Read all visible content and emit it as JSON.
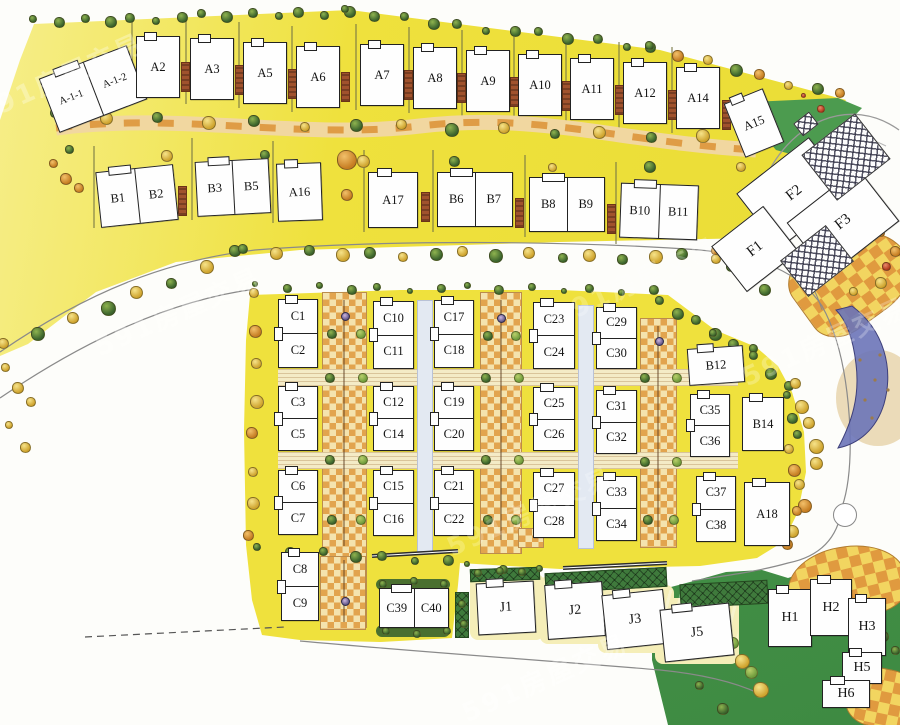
{
  "watermark": {
    "text": "591房屋交易"
  },
  "palette": {
    "lawn_yellow": "#efe13d",
    "lawn_yellow_light": "#f6ee8a",
    "lawn_green": "#4c9b4f",
    "lawn_green_dark": "#3e8a42",
    "hedge_green": "#4a7030",
    "path_tan": "#f1d7a0",
    "path_orange": "#df9c45",
    "paving_orange": "#e2a44e",
    "paving_cream": "#f4e3ae",
    "road_line": "#8a8a8a",
    "building_fill": "#fefefe",
    "building_stroke": "#222222",
    "water_blue": "#6b74b8",
    "brick_brown": "#a0522d",
    "accent_red": "#b23a1d"
  },
  "buildings": [
    {
      "labels": [
        "A-1-1",
        "A-1-2"
      ],
      "x": 46,
      "y": 60,
      "w": 94,
      "h": 58,
      "rot": -21,
      "split": "h",
      "fs": 10.5
    },
    {
      "labels": [
        "A2"
      ],
      "x": 136,
      "y": 36,
      "w": 44,
      "h": 62
    },
    {
      "labels": [
        "A3"
      ],
      "x": 190,
      "y": 38,
      "w": 44,
      "h": 62
    },
    {
      "labels": [
        "A5"
      ],
      "x": 243,
      "y": 42,
      "w": 44,
      "h": 62
    },
    {
      "labels": [
        "A6"
      ],
      "x": 296,
      "y": 46,
      "w": 44,
      "h": 62
    },
    {
      "labels": [
        "A7"
      ],
      "x": 360,
      "y": 44,
      "w": 44,
      "h": 62
    },
    {
      "labels": [
        "A8"
      ],
      "x": 413,
      "y": 47,
      "w": 44,
      "h": 62
    },
    {
      "labels": [
        "A9"
      ],
      "x": 466,
      "y": 50,
      "w": 44,
      "h": 62
    },
    {
      "labels": [
        "A10"
      ],
      "x": 518,
      "y": 54,
      "w": 44,
      "h": 62
    },
    {
      "labels": [
        "A11"
      ],
      "x": 570,
      "y": 58,
      "w": 44,
      "h": 62
    },
    {
      "labels": [
        "A12"
      ],
      "x": 623,
      "y": 62,
      "w": 44,
      "h": 62
    },
    {
      "labels": [
        "A14"
      ],
      "x": 676,
      "y": 67,
      "w": 44,
      "h": 62
    },
    {
      "labels": [
        "A15"
      ],
      "x": 733,
      "y": 94,
      "w": 42,
      "h": 58,
      "rot": -22
    },
    {
      "labels": [
        "B1",
        "B2"
      ],
      "x": 98,
      "y": 168,
      "w": 78,
      "h": 56,
      "rot": -6,
      "split": "h"
    },
    {
      "labels": [
        "B3",
        "B5"
      ],
      "x": 196,
      "y": 160,
      "w": 74,
      "h": 55,
      "rot": -3,
      "split": "h"
    },
    {
      "labels": [
        "A16"
      ],
      "x": 277,
      "y": 163,
      "w": 45,
      "h": 58,
      "rot": -2
    },
    {
      "labels": [
        "A17"
      ],
      "x": 368,
      "y": 172,
      "w": 50,
      "h": 56
    },
    {
      "labels": [
        "B6",
        "B7"
      ],
      "x": 437,
      "y": 172,
      "w": 76,
      "h": 55,
      "split": "h"
    },
    {
      "labels": [
        "B8",
        "B9"
      ],
      "x": 529,
      "y": 177,
      "w": 76,
      "h": 55,
      "split": "h"
    },
    {
      "labels": [
        "B10",
        "B11"
      ],
      "x": 620,
      "y": 184,
      "w": 78,
      "h": 55,
      "rot": 2,
      "split": "h"
    },
    {
      "labels": [
        "F2"
      ],
      "x": 748,
      "y": 158,
      "w": 92,
      "h": 70,
      "rot": -38,
      "plain": true,
      "fs": 15
    },
    {
      "labels": [
        "F3"
      ],
      "x": 798,
      "y": 188,
      "w": 90,
      "h": 68,
      "rot": -38,
      "plain": true,
      "fs": 15
    },
    {
      "labels": [
        "F1"
      ],
      "x": 722,
      "y": 220,
      "w": 66,
      "h": 58,
      "rot": -38,
      "plain": true,
      "fs": 15
    },
    {
      "labels": [
        "C1",
        "C2"
      ],
      "x": 278,
      "y": 299,
      "w": 40,
      "h": 69,
      "split": "v"
    },
    {
      "labels": [
        "C3",
        "C5"
      ],
      "x": 278,
      "y": 386,
      "w": 40,
      "h": 65,
      "split": "v"
    },
    {
      "labels": [
        "C6",
        "C7"
      ],
      "x": 278,
      "y": 470,
      "w": 40,
      "h": 65,
      "split": "v"
    },
    {
      "labels": [
        "C10",
        "C11"
      ],
      "x": 373,
      "y": 301,
      "w": 41,
      "h": 68,
      "split": "v"
    },
    {
      "labels": [
        "C12",
        "C14"
      ],
      "x": 373,
      "y": 386,
      "w": 41,
      "h": 65,
      "split": "v"
    },
    {
      "labels": [
        "C15",
        "C16"
      ],
      "x": 373,
      "y": 470,
      "w": 41,
      "h": 66,
      "split": "v"
    },
    {
      "labels": [
        "C17",
        "C18"
      ],
      "x": 434,
      "y": 300,
      "w": 40,
      "h": 68,
      "split": "v"
    },
    {
      "labels": [
        "C19",
        "C20"
      ],
      "x": 434,
      "y": 386,
      "w": 40,
      "h": 65,
      "split": "v"
    },
    {
      "labels": [
        "C21",
        "C22"
      ],
      "x": 434,
      "y": 470,
      "w": 40,
      "h": 66,
      "split": "v"
    },
    {
      "labels": [
        "C23",
        "C24"
      ],
      "x": 533,
      "y": 302,
      "w": 42,
      "h": 67,
      "split": "v"
    },
    {
      "labels": [
        "C25",
        "C26"
      ],
      "x": 533,
      "y": 387,
      "w": 42,
      "h": 64,
      "split": "v"
    },
    {
      "labels": [
        "C27",
        "C28"
      ],
      "x": 533,
      "y": 472,
      "w": 42,
      "h": 66,
      "split": "v"
    },
    {
      "labels": [
        "C29",
        "C30"
      ],
      "x": 596,
      "y": 307,
      "w": 41,
      "h": 62,
      "split": "v"
    },
    {
      "labels": [
        "C31",
        "C32"
      ],
      "x": 596,
      "y": 390,
      "w": 41,
      "h": 64,
      "split": "v"
    },
    {
      "labels": [
        "C33",
        "C34"
      ],
      "x": 596,
      "y": 476,
      "w": 41,
      "h": 65,
      "split": "v"
    },
    {
      "labels": [
        "B12"
      ],
      "x": 688,
      "y": 347,
      "w": 56,
      "h": 37,
      "rot": -4
    },
    {
      "labels": [
        "C35",
        "C36"
      ],
      "x": 690,
      "y": 394,
      "w": 40,
      "h": 63,
      "split": "v"
    },
    {
      "labels": [
        "B14"
      ],
      "x": 742,
      "y": 397,
      "w": 42,
      "h": 54
    },
    {
      "labels": [
        "C37",
        "C38"
      ],
      "x": 696,
      "y": 476,
      "w": 40,
      "h": 66,
      "split": "v"
    },
    {
      "labels": [
        "A18"
      ],
      "x": 744,
      "y": 482,
      "w": 46,
      "h": 64
    },
    {
      "labels": [
        "C8",
        "C9"
      ],
      "x": 281,
      "y": 552,
      "w": 38,
      "h": 69,
      "split": "v"
    },
    {
      "labels": [
        "C39",
        "C40"
      ],
      "x": 379,
      "y": 588,
      "w": 70,
      "h": 40,
      "split": "h"
    },
    {
      "labels": [
        "J1"
      ],
      "x": 477,
      "y": 582,
      "w": 58,
      "h": 52,
      "rot": -3,
      "fs": 14
    },
    {
      "labels": [
        "J2"
      ],
      "x": 546,
      "y": 583,
      "w": 58,
      "h": 55,
      "rot": -4,
      "fs": 14
    },
    {
      "labels": [
        "J3"
      ],
      "x": 604,
      "y": 592,
      "w": 62,
      "h": 55,
      "rot": -6,
      "fs": 14
    },
    {
      "labels": [
        "J5"
      ],
      "x": 662,
      "y": 606,
      "w": 70,
      "h": 53,
      "rot": -6,
      "fs": 14
    },
    {
      "labels": [
        "H1"
      ],
      "x": 768,
      "y": 589,
      "w": 44,
      "h": 58,
      "fs": 14
    },
    {
      "labels": [
        "H2"
      ],
      "x": 810,
      "y": 579,
      "w": 42,
      "h": 57,
      "fs": 14
    },
    {
      "labels": [
        "H3"
      ],
      "x": 848,
      "y": 598,
      "w": 38,
      "h": 58,
      "fs": 14
    },
    {
      "labels": [
        "H5"
      ],
      "x": 842,
      "y": 652,
      "w": 40,
      "h": 32,
      "fs": 14
    },
    {
      "labels": [
        "H6"
      ],
      "x": 822,
      "y": 680,
      "w": 48,
      "h": 28,
      "fs": 14
    }
  ]
}
